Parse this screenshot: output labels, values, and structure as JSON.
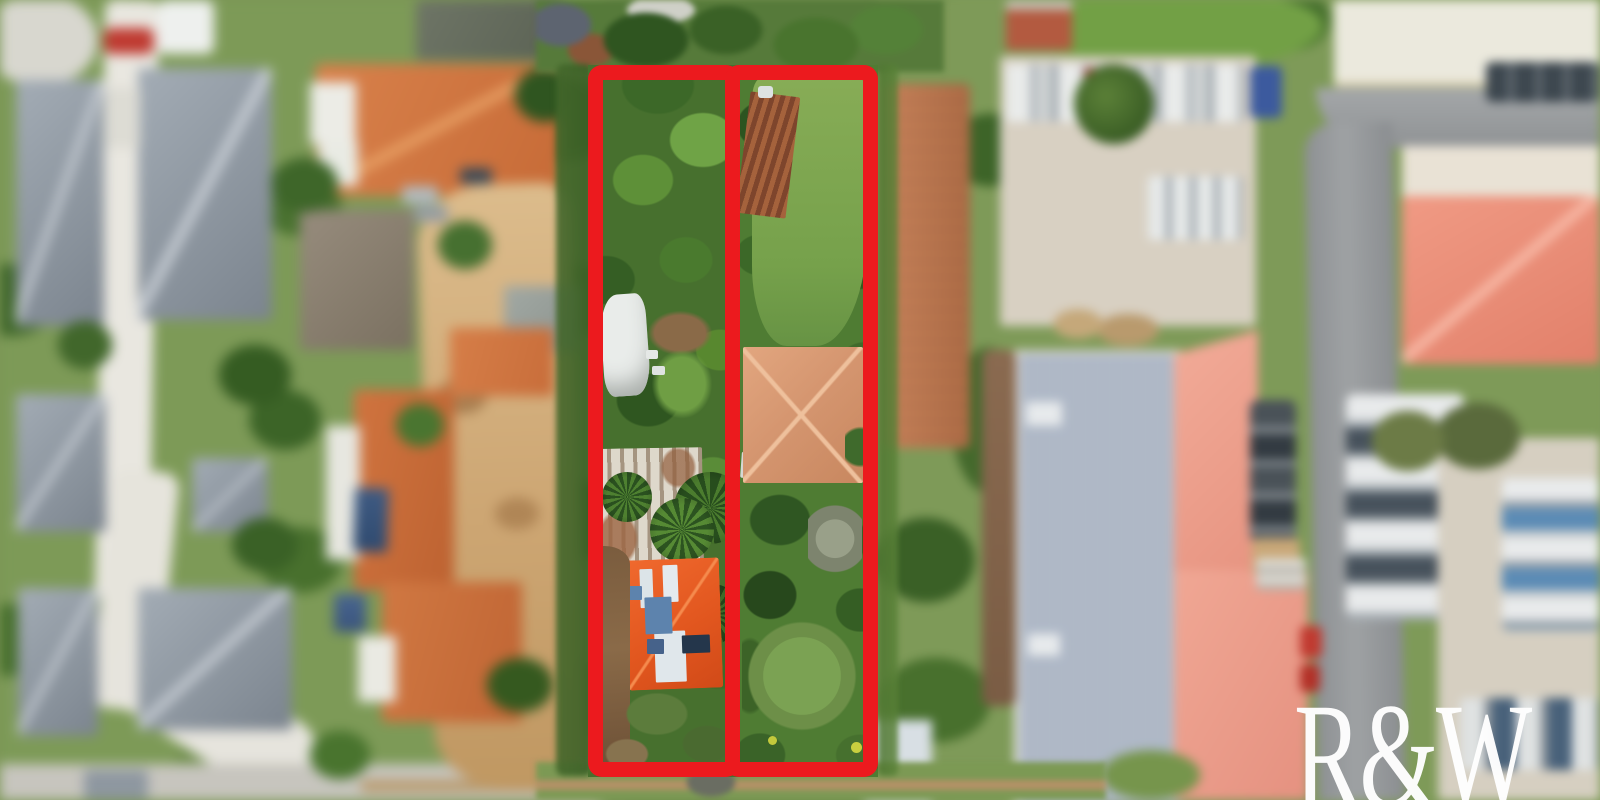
{
  "watermark": {
    "label": "R&W",
    "color": "#ffffff"
  },
  "boundary_overlay": {
    "color": "#ec1a1e",
    "lot_count": 2,
    "lots": [
      "left-lot",
      "right-lot"
    ]
  }
}
